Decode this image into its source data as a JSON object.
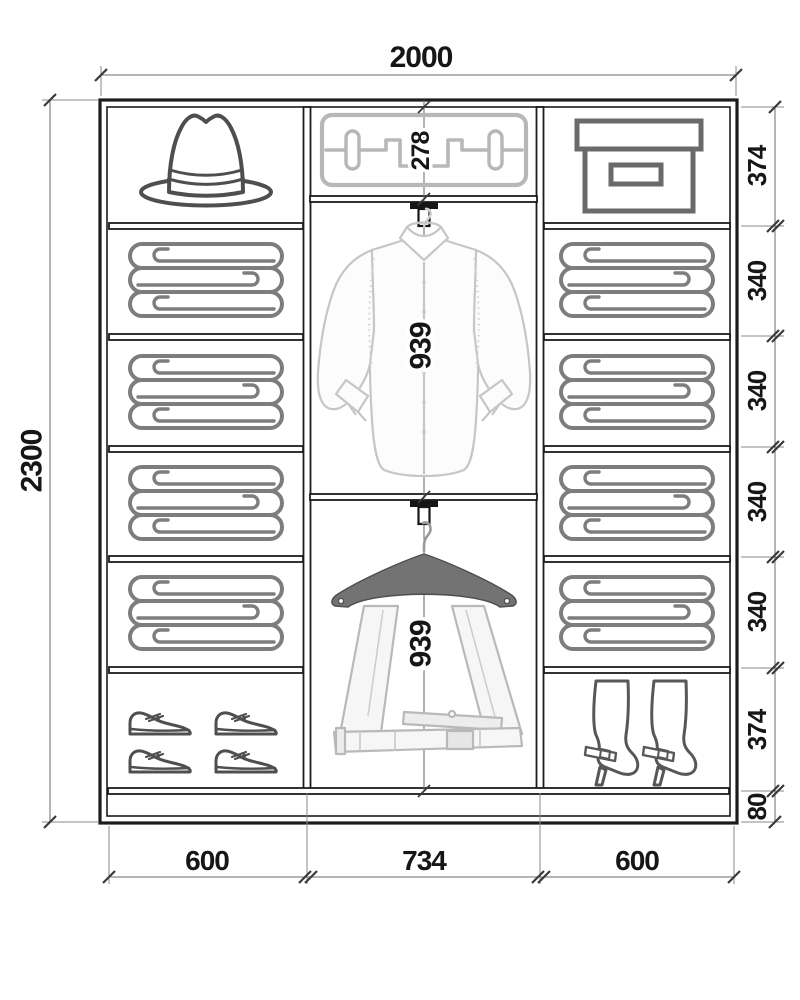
{
  "diagram": {
    "subject": "wardrobe-interior-layout",
    "dimensions": {
      "overall_width": "2000",
      "overall_height": "2300",
      "column_widths": [
        "600",
        "734",
        "600"
      ],
      "right_section_heights": [
        "374",
        "340",
        "340",
        "340",
        "340",
        "374",
        "80"
      ],
      "pullout_rack_height": "278",
      "shirt_section_height": "939",
      "trouser_section_height": "939"
    },
    "contents": {
      "left_column": [
        "hat",
        "folded-blanket",
        "folded-blanket",
        "folded-blanket",
        "folded-blanket",
        "dress-shoes"
      ],
      "middle_column": [
        "pull-out-rack",
        "shirt-on-rod",
        "trousers-on-hanger"
      ],
      "right_column": [
        "storage-box",
        "folded-blanket",
        "folded-blanket",
        "folded-blanket",
        "folded-blanket",
        "high-heel-boots"
      ]
    },
    "colors": {
      "outline": "#1c1c1c",
      "dimension": "#6b6b6b",
      "icon_dark": "#4f4f4f",
      "icon_mid": "#7d7d7d",
      "icon_light": "#b7b7b7",
      "background": "#ffffff"
    }
  }
}
